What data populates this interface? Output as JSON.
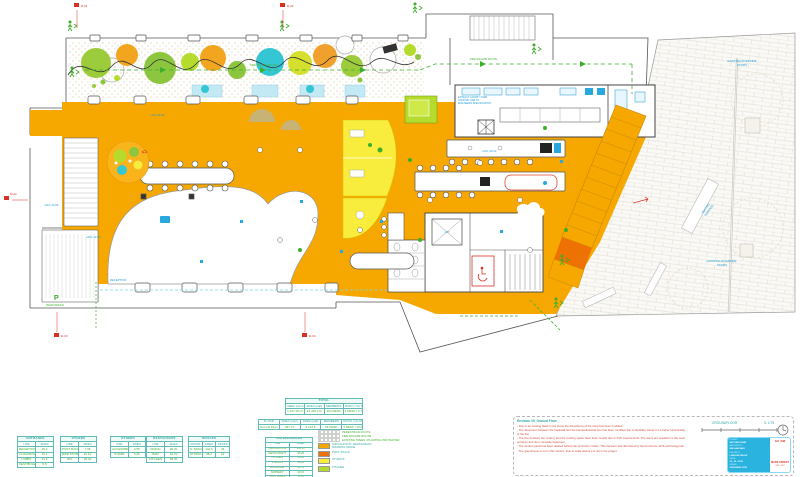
{
  "palette": {
    "floor_orange": "#F6A800",
    "accent_orange": "#EE7203",
    "yellow": "#F8EC3D",
    "lime": "#B5DC2C",
    "tree_green": "#8CC63F",
    "tree_cyan": "#35C6D4",
    "planter_blue": "#C3E9F4",
    "ink_blue": "#1C9AD6",
    "route_green": "#3DAE2B",
    "marker_red": "#D93025",
    "table_teal": "#2FA8A0",
    "titleblock_cyan": "#2BB3E0"
  },
  "markers": {
    "d01": "D-01",
    "d02": "D-02",
    "m01": "M-01",
    "d03": "D-03",
    "d04": "D-04"
  },
  "plan_labels": {
    "riverside_1": "EXISTING RIVERSIDE",
    "riverside_2": "STAIRS",
    "seating_1": "SEATING",
    "seating_2": "TERRACE",
    "ffl_a": "+FFL 30.90",
    "ffl_b": "+FFL 32.80",
    "ffl_c": "+FFL 32.90",
    "ffl_d": "+FFL 33.10",
    "reception": "RECEPTION",
    "lift": "LIFT",
    "pram_p": "P",
    "pram": "PRAM PARKING",
    "fire_route": "FIRE ESCAPE ROUTE",
    "kitchen_note_1": "EXTRACT CANOPY OVER",
    "kitchen_note_2": "COOKING LINE TO",
    "kitchen_note_3": "ENGINEERS SPECIFICATION",
    "groundfloor": "GROUNDFLOOR",
    "scale": "S: 1/75"
  },
  "tables": {
    "entrance": {
      "title": "ENTRANCE",
      "columns": [
        "USE",
        "AREA"
      ],
      "rows": [
        [
          "RECEPTION",
          "15.2"
        ],
        [
          "CLOAKROOM",
          "10.1"
        ],
        [
          "LOBBY",
          "31.6"
        ],
        [
          "VESTIBULE",
          "5.8"
        ]
      ]
    },
    "others_a": {
      "title": "OTHERS",
      "columns": [
        "USE",
        "AREA"
      ],
      "rows": [
        [
          "POST ROOM",
          "7.95"
        ],
        [
          "BIKE STORAGE",
          "21.10"
        ],
        [
          "WC",
          "25.40"
        ]
      ]
    },
    "others_b": {
      "title": "OTHERS",
      "columns": [
        "USE",
        "AREA"
      ],
      "rows": [
        [
          "ACCESSIBLE WC",
          "4.55"
        ],
        [
          "STORE",
          "6.20"
        ]
      ]
    },
    "restaurant": {
      "title": "RESTAURANT",
      "columns": [
        "USE",
        "AREA"
      ],
      "rows": [
        [
          "DINING",
          "96.20"
        ],
        [
          "BAR",
          "42.70"
        ],
        [
          "KITCHEN",
          "58.30"
        ]
      ]
    },
    "offices": {
      "title": "OFFICES",
      "columns": [
        "ROOM",
        "AREA",
        "DESKS"
      ],
      "rows": [
        [
          "S. SPACE",
          "142.5",
          "46"
        ],
        [
          "STUDIO 1",
          "38.2",
          "12"
        ]
      ]
    },
    "total": {
      "title": "TOTAL",
      "columns": [
        "AREA (sqm)",
        "AREA (sqft)",
        "MEMBERS",
        "RATIO / No MEMBERS"
      ],
      "rows": [
        [
          "1,247.25 m²",
          "13,425.3 ft²",
          "264 DESK",
          "1 DESK / 4.72 m²"
        ]
      ]
    },
    "floor": {
      "columns": [
        "FLOOR",
        "AREA (sqm)",
        "AREA (sqft)",
        "MEMBERS",
        "RATIO / No MEMBERS"
      ],
      "rows": [
        [
          "Ground Floor",
          "847.70",
          "9,124.5",
          "64 DESK",
          "1 DESK / 13.2 m²"
        ]
      ]
    },
    "use_breakdown": {
      "title": "USE BREAKDOWN",
      "columns": [
        "USE",
        "AREA"
      ],
      "rows": [
        [
          "CIRCULATION",
          "302.40"
        ],
        [
          "RESTAURANT",
          "96.20"
        ],
        [
          "KITCHEN",
          "58.30"
        ],
        [
          "STUDIOS",
          "84.60"
        ],
        [
          "ENTRANCE",
          "62.70"
        ],
        [
          "NURSERY",
          "22.15"
        ],
        [
          "POST SNACK",
          "19.35"
        ],
        [
          "TOTAL",
          "847.70"
        ]
      ]
    }
  },
  "legend": {
    "routes": [
      "PEDESTRIAN ROUTE",
      "FIRE ESCAPE ROUTE",
      "EXISTING TREES / PLANTING PROTECTED"
    ],
    "fills": [
      {
        "color": "#F6A800",
        "label": "CIRCULATION / RESTAURANT",
        "label2": "ROAMING SPACE"
      },
      {
        "color": "#EE7203",
        "label": "POST SNACK",
        "label2": ""
      },
      {
        "color": "#F8EC3D",
        "label": "STUDIOS",
        "label2": ""
      },
      {
        "color": "#B5DC2C",
        "label": "KITCHEN",
        "label2": ""
      }
    ]
  },
  "notes": {
    "title": "Revision 09_Ground Floor",
    "items": [
      "- Due to an existing hatch in the street the dimensions of the ramp has been modified.",
      "- The dimension between the backwall and the banquettes/side box has been modified due to flexibility issues for a better functionality of the bar.",
      "- The line between the nursery and the cooking space have been modify due to KVA requirements. The doors are speakers in the main entrance and door complete basement.",
      "- The sunken panel has been deleted behind the perimeter curtain. This decision was discussed by Second Home, ETA and hansgrohe.",
      "- The greenhouse is not in this version. Due to scale issues it is not in the project."
    ]
  },
  "titleblock": {
    "lines": [
      "CLIENT:",
      "SECOND HOME",
      "ARCHITECT:",
      "SELGASCANO",
      "PROJECT:",
      "LONDON FIELDS",
      "DATE:",
      "10 . 05 . 2016",
      "STAGE:",
      "GROUNDFLOOR"
    ],
    "job": "A04_J098",
    "street": "MARE STREET",
    "street_no": "125 - 127"
  }
}
